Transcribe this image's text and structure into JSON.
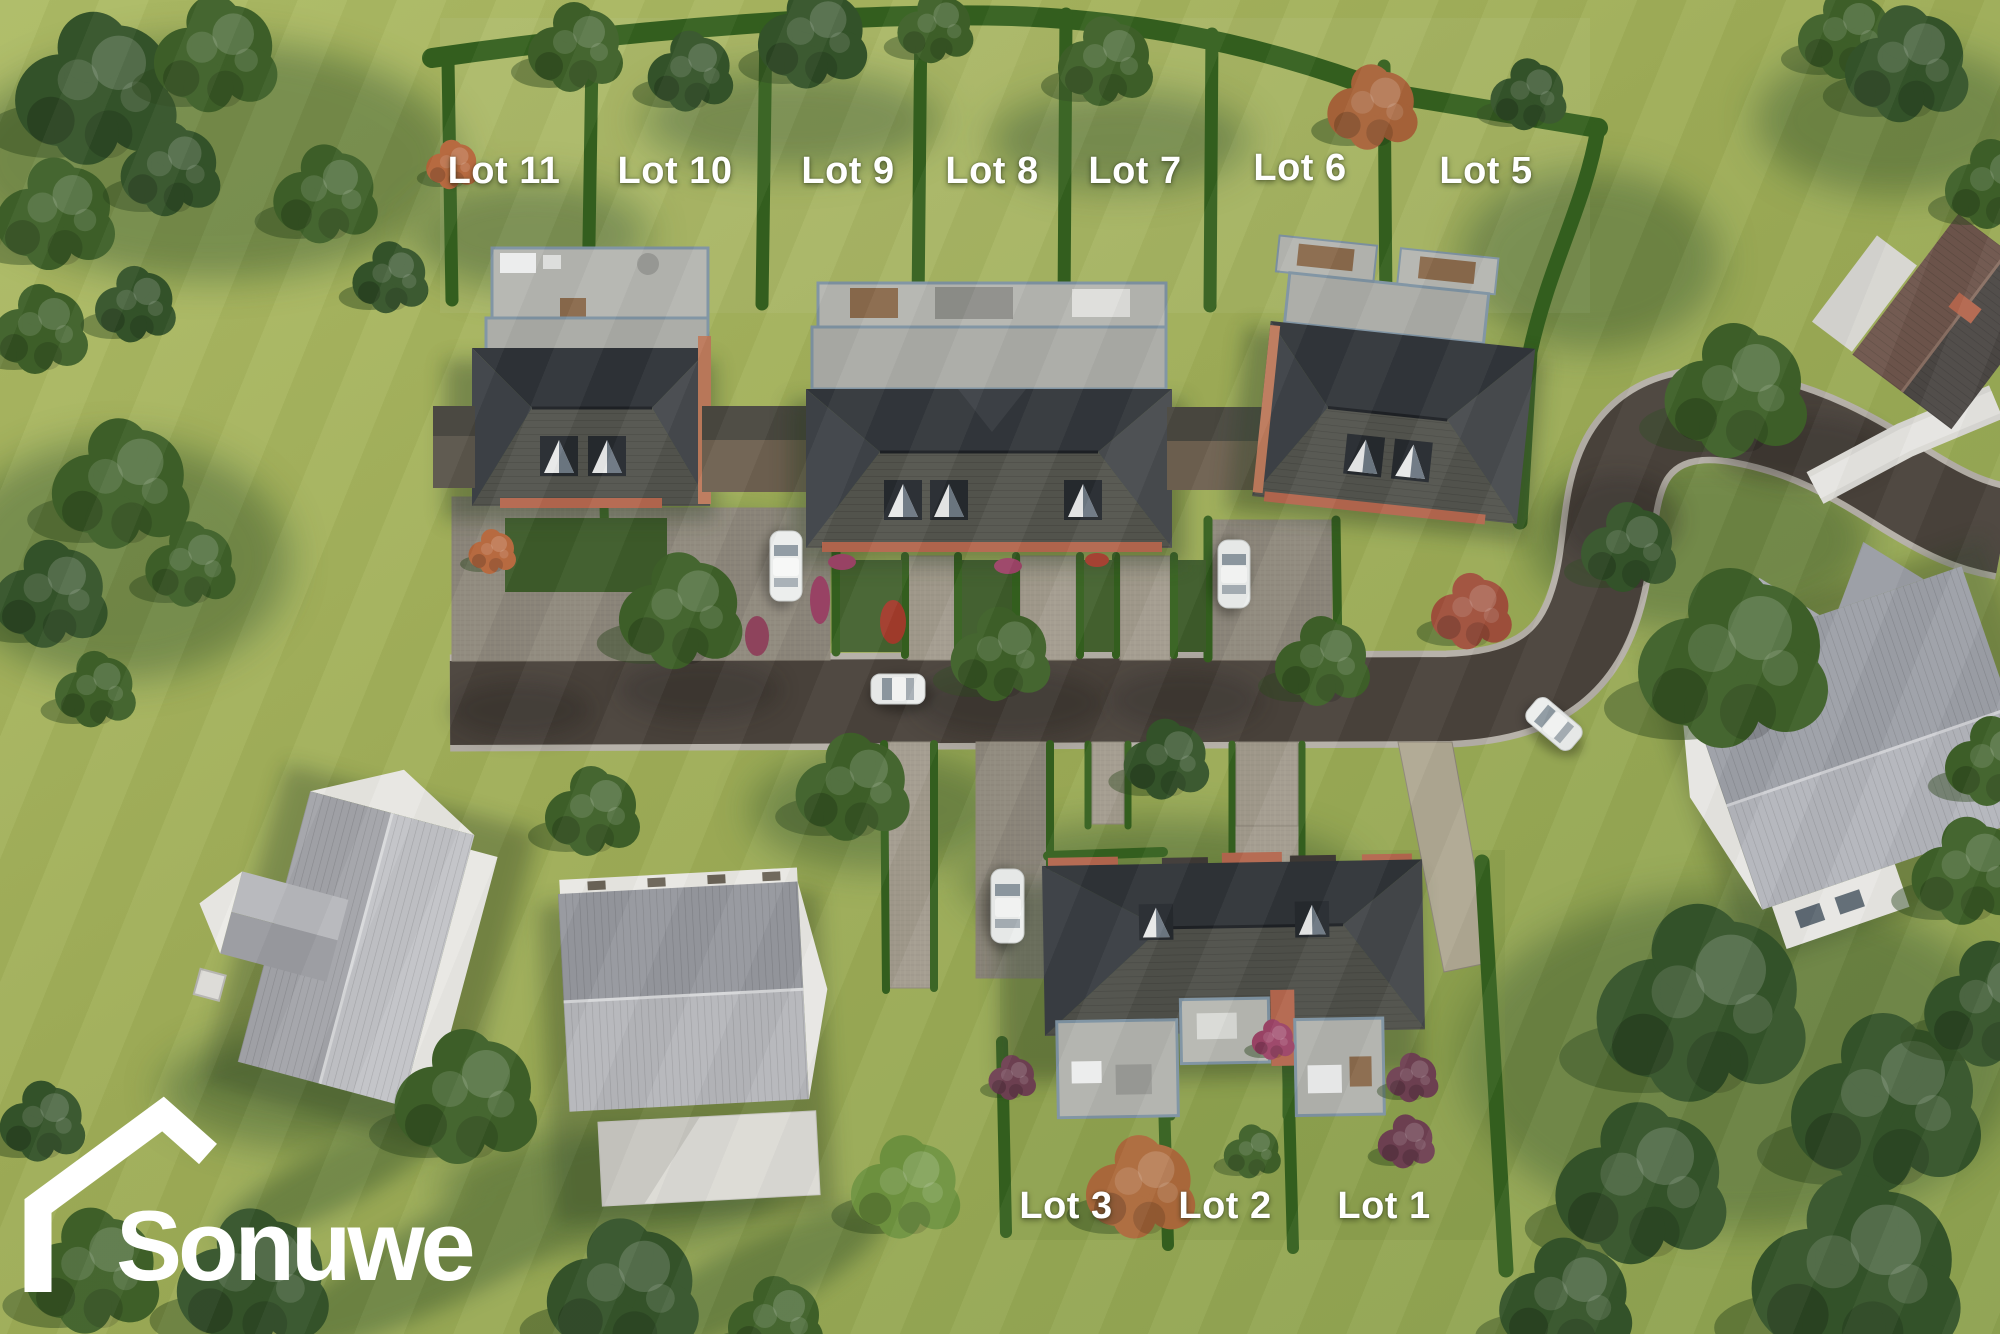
{
  "logo": {
    "text": "Sonuwe",
    "icon": "house-roof-outline-icon"
  },
  "lots": [
    {
      "id": "lot-11",
      "label": "Lot 11"
    },
    {
      "id": "lot-10",
      "label": "Lot 10"
    },
    {
      "id": "lot-9",
      "label": "Lot 9"
    },
    {
      "id": "lot-8",
      "label": "Lot 8"
    },
    {
      "id": "lot-7",
      "label": "Lot 7"
    },
    {
      "id": "lot-6",
      "label": "Lot 6"
    },
    {
      "id": "lot-5",
      "label": "Lot 5"
    },
    {
      "id": "lot-3",
      "label": "Lot 3"
    },
    {
      "id": "lot-2",
      "label": "Lot 2"
    },
    {
      "id": "lot-1",
      "label": "Lot 1"
    }
  ],
  "palette": {
    "grass": "#9fae58",
    "grass_light": "#b2c069",
    "grass_shadow": "#51683a",
    "road_asphalt": "#4a433c",
    "road_curb": "#b5b0a7",
    "paver": "#a29b8d",
    "apron_paver": "#8e887c",
    "patio": "#b5b6b1",
    "patio_trim": "#7e93a2",
    "roof_dark": "#2f3338",
    "roof_slope": "#53544e",
    "garage_roof": "#6e6150",
    "brick": "#b4674e",
    "hedge": "#35611f",
    "tree_green": "#3f6129",
    "tree_dark": "#35542a",
    "tree_bright": "#6f9440",
    "tree_autumn": "#a8643a",
    "shrub_purple": "#6f4152",
    "flower_red": "#a23c2c",
    "flower_magenta": "#9c4467",
    "existing_roof": "#aeb0b5",
    "existing_wall": "#e9e8e3",
    "car_body": "#eceeed",
    "label_text": "#ffffff",
    "logo_color": "#ffffff"
  }
}
